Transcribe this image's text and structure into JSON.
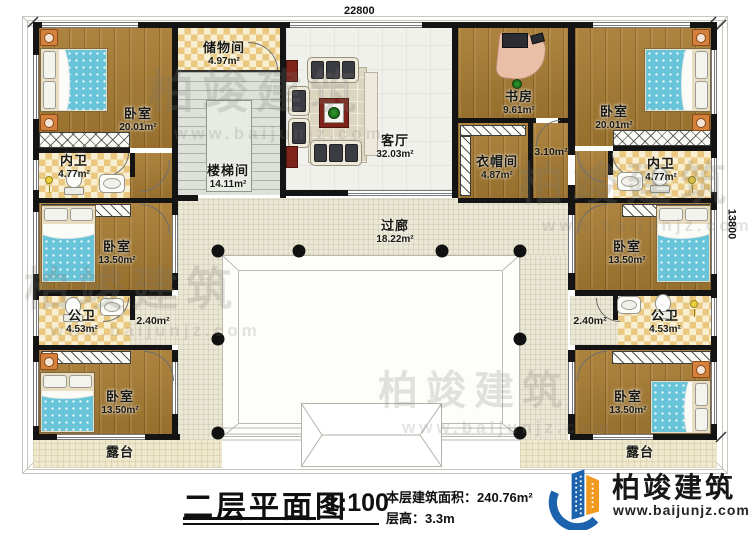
{
  "plan": {
    "dimensions": {
      "top": "22800",
      "right": "13800"
    },
    "rooms": {
      "storage": {
        "name": "储物间",
        "area": "4.97m²"
      },
      "bedroom_tl": {
        "name": "卧室",
        "area": "20.01m²"
      },
      "neiwei_l": {
        "name": "内卫",
        "area": "4.77m²"
      },
      "bedroom_ml": {
        "name": "卧室",
        "area": "13.50m²"
      },
      "gongwei_l": {
        "name": "公卫",
        "area": "4.53m²"
      },
      "hall_l": {
        "area": "2.40m²"
      },
      "bedroom_bl": {
        "name": "卧室",
        "area": "13.50m²"
      },
      "stair": {
        "name": "楼梯间",
        "area": "14.11m²"
      },
      "living": {
        "name": "客厅",
        "area": "32.03m²"
      },
      "study": {
        "name": "书房",
        "area": "9.61m²"
      },
      "cloak": {
        "name": "衣帽间",
        "area": "4.87m²"
      },
      "hall_310": {
        "area": "3.10m²"
      },
      "corridor": {
        "name": "过廊",
        "area": "18.22m²"
      },
      "bedroom_tr": {
        "name": "卧室",
        "area": "20.01m²"
      },
      "neiwei_r": {
        "name": "内卫",
        "area": "4.77m²"
      },
      "bedroom_mr": {
        "name": "卧室",
        "area": "13.50m²"
      },
      "gongwei_r": {
        "name": "公卫",
        "area": "4.53m²"
      },
      "hall_r": {
        "area": "2.40m²"
      },
      "bedroom_br": {
        "name": "卧室",
        "area": "13.50m²"
      },
      "terrace_l": {
        "name": "露台"
      },
      "terrace_r": {
        "name": "露台"
      }
    }
  },
  "watermark": {
    "text": "柏竣建筑",
    "url": "www.baijunjz.com"
  },
  "title_block": {
    "title": "二层平面图",
    "scale": "1:100",
    "area_label": "本层建筑面积：",
    "area_value": "240.76m²",
    "height_label": "层高：",
    "height_value": "3.3m"
  },
  "logo": {
    "name": "柏竣建筑",
    "url": "www.baijunjz.com"
  },
  "colors": {
    "wall": "#141414",
    "wood": "#a87c33",
    "tile": "#eac87f",
    "bed": "#68c4d9",
    "logo_blue": "#1c63ad",
    "logo_orange": "#f29a1f"
  }
}
